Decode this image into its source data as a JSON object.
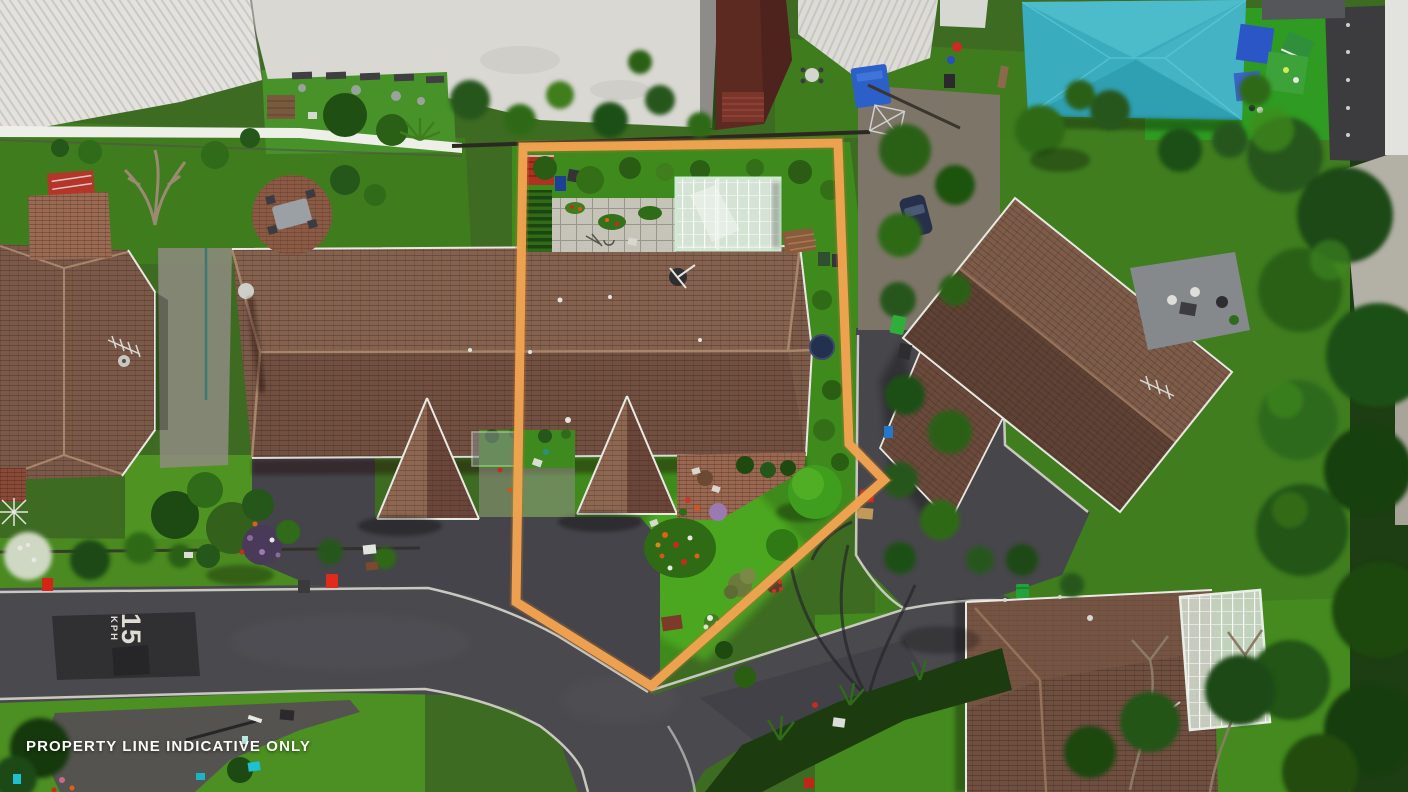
{
  "meta": {
    "type": "aerial-drone-photograph",
    "subject": "residential property with highlighted boundary"
  },
  "overlay": {
    "caption": "PROPERTY LINE INDICATIVE ONLY",
    "boundary_color": "#F1A351",
    "boundary_points": "523,147 838,143 849,444 884,480 651,686 516,602"
  },
  "road_marking": {
    "speed": "15",
    "unit": "KPH",
    "paint_color": "#DFDDD3"
  },
  "palette": {
    "roof_tile_brown": "#7B5A49",
    "roof_tile_shadow": "#6A463A",
    "lawn_bright": "#4FAE1D",
    "lawn_mid": "#3F7D1E",
    "foliage_dark": "#1D4A12",
    "asphalt": "#4A494E",
    "asphalt_patch": "#2E2E31",
    "kerb": "#C9C8C0",
    "concrete_paving": "#C6C3B8",
    "white_roof": "#D9D8D3",
    "shade_sail_teal": "#39ADBE",
    "barn_red": "#5D2A22",
    "greenhouse_frame": "#CDEBD2"
  },
  "scene": {
    "subject_property_features": [
      "greenhouse",
      "paved patio",
      "vegetable garden",
      "red garden shed",
      "tiled hip-roof house",
      "front gable",
      "satellite dish",
      "front lawn",
      "flower beds",
      "asphalt driveway"
    ],
    "surroundings": [
      "white industrial roofs",
      "dark red barn",
      "teal shade sail over playground",
      "neighbouring duplex unit",
      "left house with TV aerial",
      "right house with grey deck",
      "bottom-right house with glass conservatory",
      "cul-de-sac road",
      "15 KPH road marking",
      "wheelie bins",
      "street lamp shadow"
    ]
  }
}
